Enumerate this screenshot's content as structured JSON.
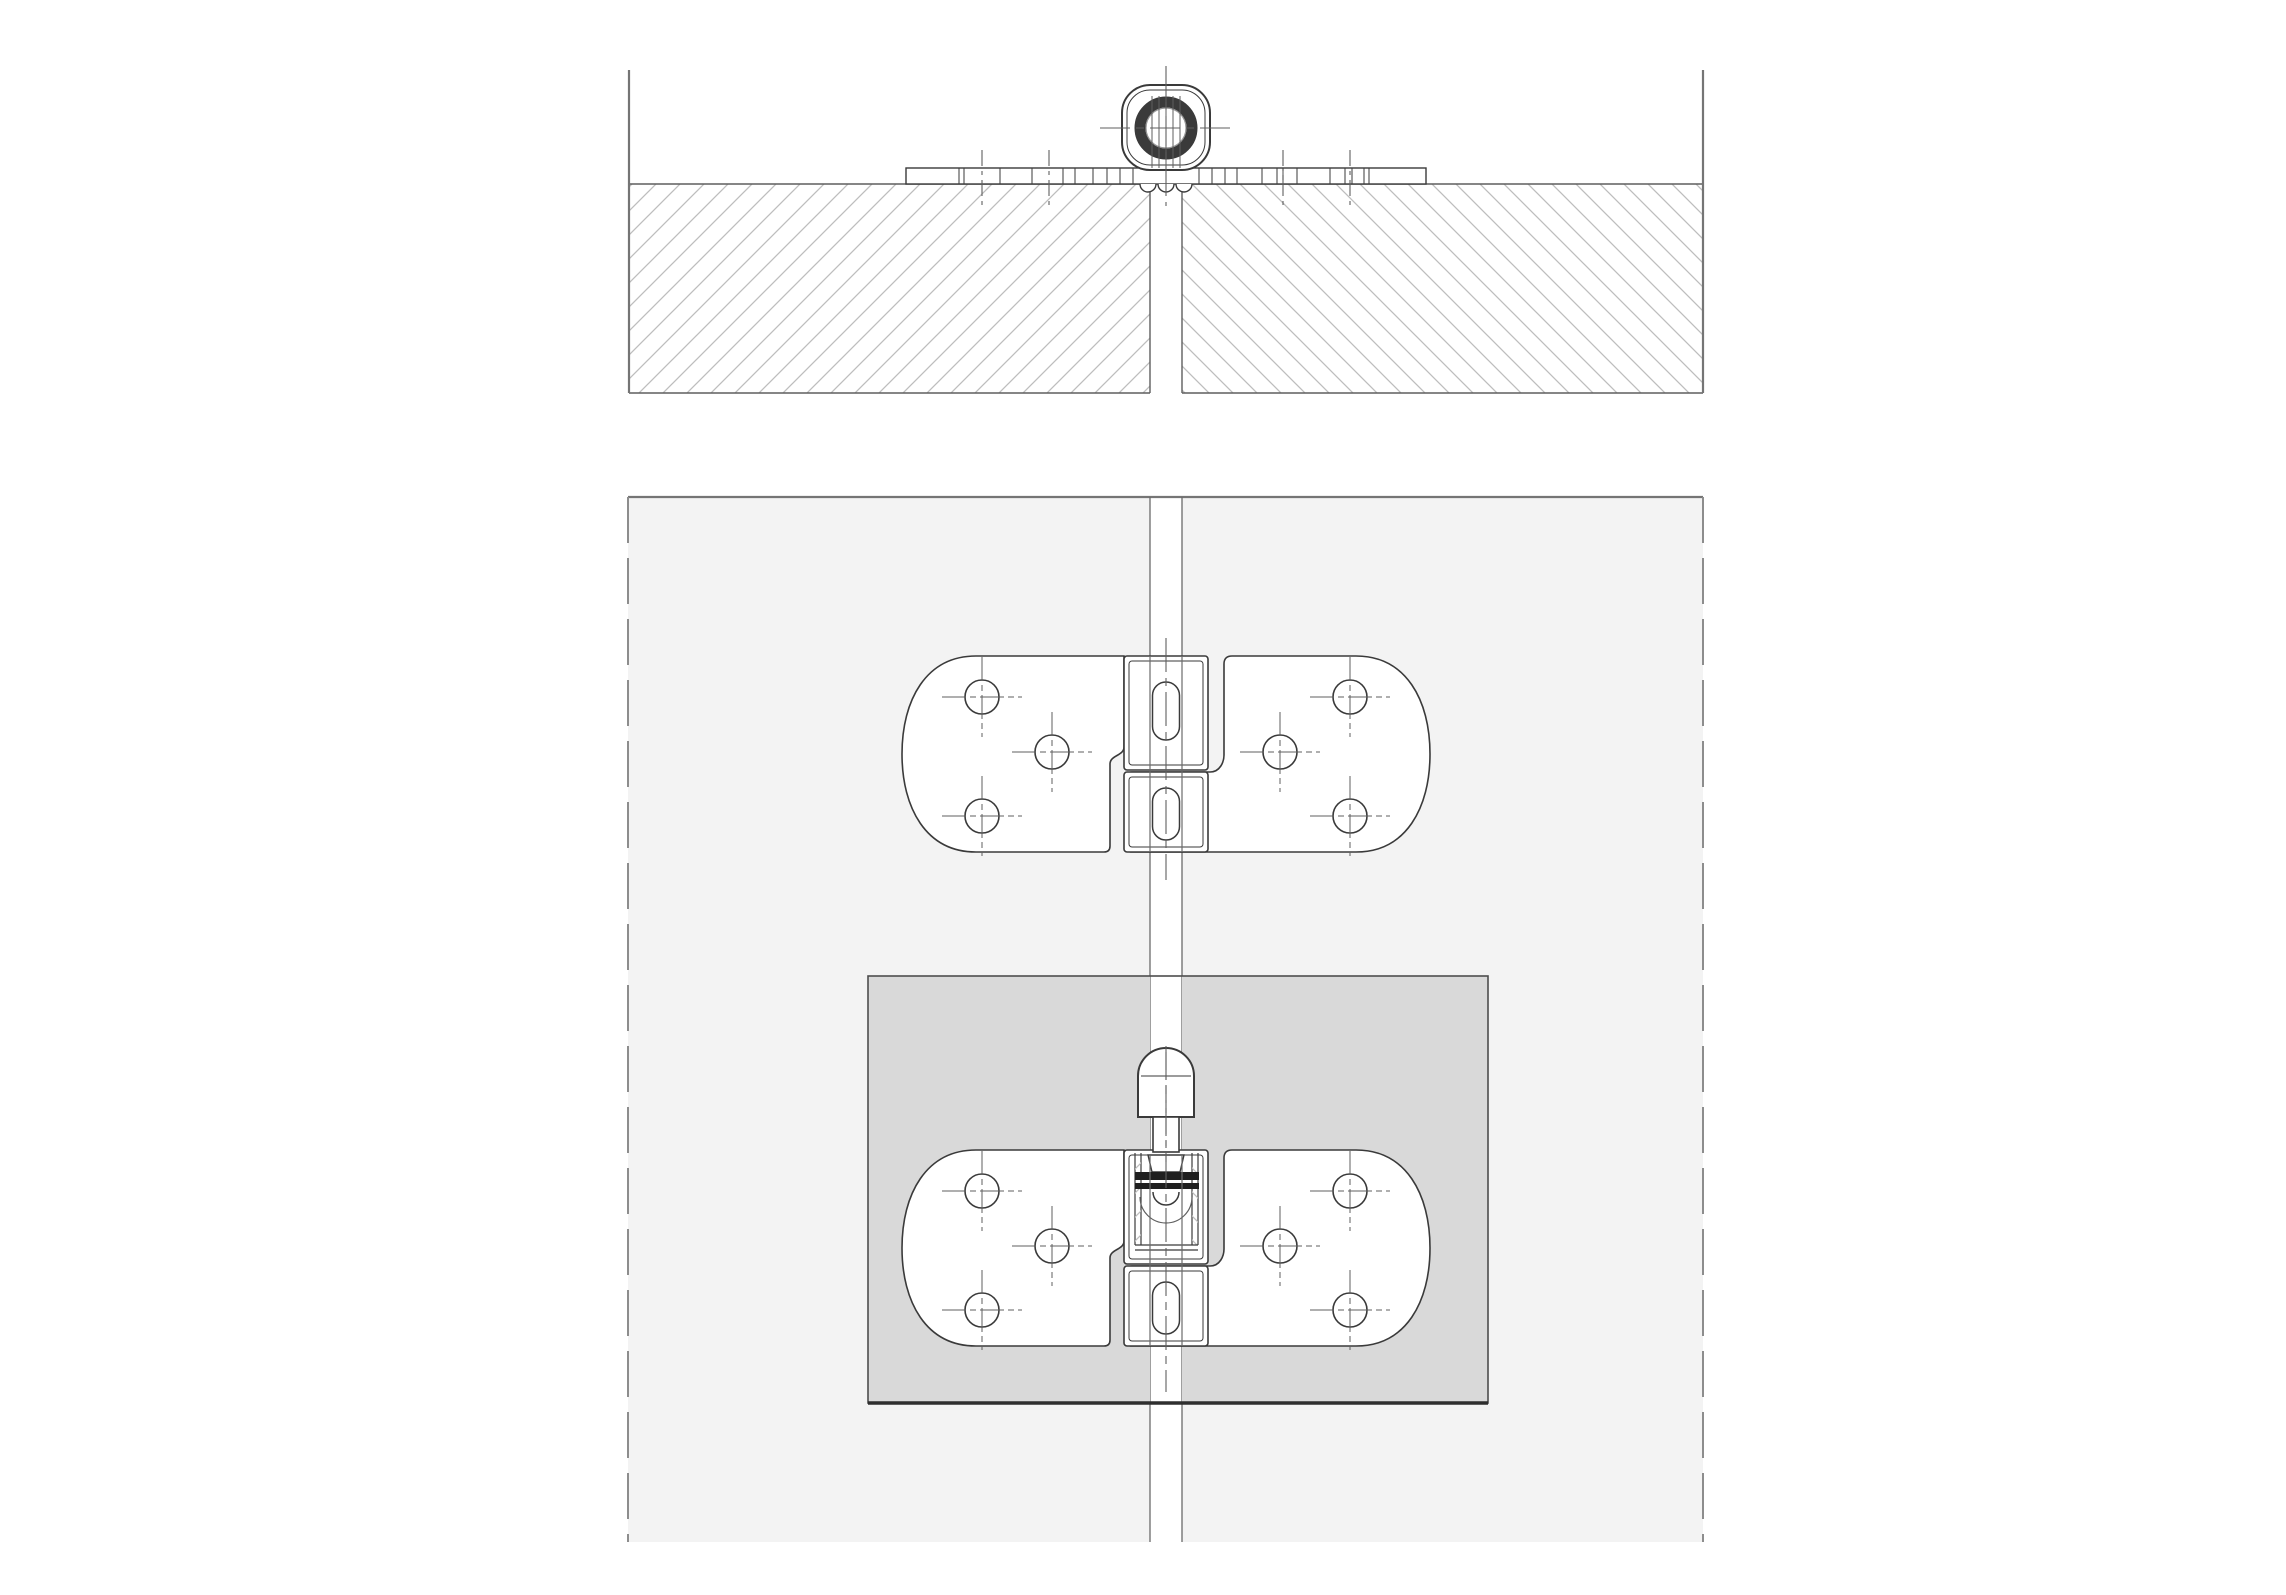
{
  "meta": {
    "title": "flap-hinge-installation-technical-drawing",
    "canvas_width": 2286,
    "canvas_height": 1595
  },
  "colors": {
    "paper": "#ffffff",
    "line_dark": "#3a3a3a",
    "line_medium": "#5f5f5f",
    "line_border": "#757575",
    "line_seam": "#6b6b6b",
    "hatch": "#bdbdbd",
    "panel_fill": "#f3f3f3",
    "recess_fill": "#d9d9d9",
    "recess_edge": "#4d4d4d",
    "recess_bottom_edge": "#2e2e2e",
    "fitting_fill": "#ffffff",
    "nut_dark": "#1f1f1f"
  },
  "section_view": {
    "border_left_x": 629,
    "border_right_x": 1703,
    "border_top_y": 70,
    "slab_top_y": 184,
    "slab_bottom_y": 393,
    "gap_left_x": 1150,
    "gap_right_x": 1182,
    "hatch_pitch": 24,
    "plate": {
      "x1": 906,
      "x2": 1426,
      "y1": 168,
      "y2": 184,
      "ticks": [
        959,
        964,
        1000,
        1032,
        1063,
        1075,
        1093,
        1107,
        1120,
        1133,
        1199,
        1212,
        1225,
        1237,
        1262,
        1277,
        1283,
        1297,
        1330,
        1345,
        1352,
        1364,
        1369
      ]
    },
    "screw_centerlines": {
      "xs": [
        982,
        1049,
        1283,
        1350
      ],
      "y1": 150,
      "y2": 206
    },
    "knuckle": {
      "cx": 1166,
      "cy": 128,
      "box": {
        "x": 1122,
        "y": 85,
        "w": 88,
        "h": 85,
        "r": 28,
        "inset": 5
      },
      "ring_r": 26,
      "ring_w": 11,
      "bore_r": 20,
      "pin_lines": [
        1152,
        1159,
        1166,
        1173,
        1180
      ],
      "pin_line_top_y": 96,
      "pin_line_bottom_y": 168,
      "curl_centers": [
        1148,
        1166,
        1184
      ],
      "curl_r": 8,
      "centerline_v": {
        "x": 1166,
        "y1": 66,
        "y2": 206
      },
      "centerline_h": {
        "y": 128,
        "x1": 1100,
        "x2": 1232
      }
    }
  },
  "plan_view": {
    "area": {
      "x1": 628,
      "x2": 1703,
      "y1": 497,
      "y2": 1542
    },
    "seam": {
      "x_left": 1150,
      "x_right": 1182
    },
    "center_x": 1166,
    "recess": {
      "x1": 868,
      "y1": 976,
      "x2": 1488,
      "y2": 1403
    },
    "hinge_shape": {
      "tip_left_x": 902,
      "tip_right_x": 1430,
      "body_left_x": 976,
      "body_right_x": 1356,
      "inner_left_x": 1124,
      "inner_right_x": 1224,
      "step_out_left_x": 1110,
      "knuckle_x1": 1124,
      "knuckle_x2": 1208,
      "knuckle_inset": 5,
      "j1_dy": 91,
      "j2_dy": 108,
      "split_dy": 116,
      "hole_r": 17,
      "cross_arm": 40
    },
    "hinges": [
      {
        "name": "upper-hinge",
        "y_top": 656,
        "y_bottom": 852,
        "holes": [
          [
            982,
            697
          ],
          [
            1052,
            752
          ],
          [
            982,
            816
          ],
          [
            1350,
            697
          ],
          [
            1280,
            752
          ],
          [
            1350,
            816
          ]
        ],
        "slots": [
          [
            1166,
            711,
            27,
            58
          ],
          [
            1166,
            814,
            27,
            52
          ]
        ],
        "has_nut_section": false,
        "centerline_y": [
          638,
          880
        ]
      },
      {
        "name": "lower-hinge",
        "y_top": 1150,
        "y_bottom": 1346,
        "holes": [
          [
            982,
            1191
          ],
          [
            1052,
            1246
          ],
          [
            982,
            1310
          ],
          [
            1350,
            1191
          ],
          [
            1280,
            1246
          ],
          [
            1350,
            1310
          ]
        ],
        "slots": [
          [
            1166,
            1308,
            27,
            52
          ]
        ],
        "has_nut_section": true,
        "centerline_y": [
          1046,
          1392
        ]
      }
    ],
    "nut_section": {
      "side_lines": [
        1135,
        1141,
        1192,
        1198
      ],
      "side_line_y1": 1153,
      "side_line_y2": 1245,
      "bolt_taper": [
        1148,
        1155,
        1184,
        1172
      ],
      "band1": {
        "x1": 1135,
        "x2": 1199,
        "y1": 1172,
        "y2": 1180
      },
      "band2": {
        "x1": 1135,
        "x2": 1199,
        "y1": 1183,
        "y2": 1189
      },
      "tip_arc": {
        "cx": 1166,
        "cy": 1192,
        "r": 13
      },
      "bore_arc": {
        "cx": 1166,
        "cy": 1197,
        "r": 26
      },
      "divider_y1": 1245,
      "divider_y2": 1250
    },
    "pin": {
      "cx": 1166,
      "dome_x1": 1138,
      "dome_x2": 1194,
      "dome_top_y": 1048,
      "dome_shoulder_y": 1076,
      "tangent_y": 1076,
      "dome_bottom_y": 1117,
      "shaft_x1": 1153,
      "shaft_x2": 1179,
      "shaft_bottom_y": 1152,
      "centerline": {
        "x": 1166,
        "y1": 1052,
        "y2": 1162
      }
    }
  }
}
